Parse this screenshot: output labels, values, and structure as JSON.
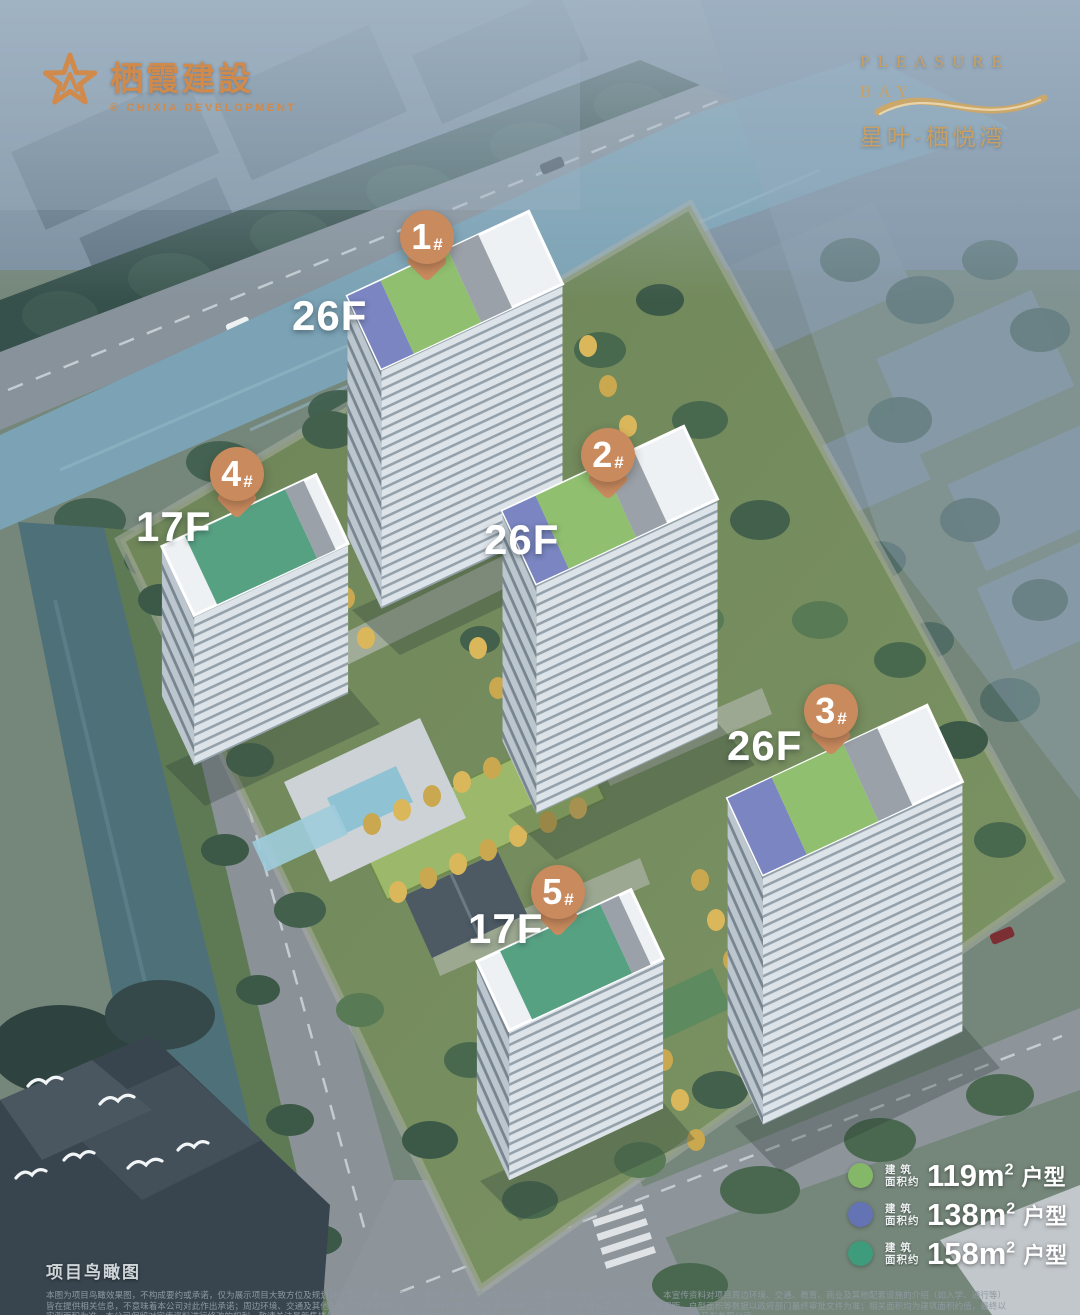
{
  "branding": {
    "developer": {
      "name_zh": "栖霞建設",
      "mark": "®",
      "name_en": "CHIXIA DEVELOPMENT",
      "color": "#cf8a4c"
    },
    "project": {
      "en_line1": "PLEASURE",
      "en_line2": "BAY",
      "name_zh": "星叶·栖悦湾",
      "color": "#c8a065"
    }
  },
  "markers": {
    "pin_color": "#c98a5e",
    "buildings": [
      {
        "number": "1",
        "hash": "#",
        "floors": "26F"
      },
      {
        "number": "2",
        "hash": "#",
        "floors": "26F"
      },
      {
        "number": "3",
        "hash": "#",
        "floors": "26F"
      },
      {
        "number": "4",
        "hash": "#",
        "floors": "17F"
      },
      {
        "number": "5",
        "hash": "#",
        "floors": "17F"
      }
    ]
  },
  "legend": {
    "items": [
      {
        "color": "#85b768",
        "label_top": "建  筑",
        "label_bottom": "面积约",
        "area": "119m",
        "sup": "2",
        "type": "户型"
      },
      {
        "color": "#6473b4",
        "label_top": "建  筑",
        "label_bottom": "面积约",
        "area": "138m",
        "sup": "2",
        "type": "户型"
      },
      {
        "color": "#3e9c7c",
        "label_top": "建  筑",
        "label_bottom": "面积约",
        "area": "158m",
        "sup": "2",
        "type": "户型"
      }
    ]
  },
  "footer": {
    "title": "项目鸟瞰图",
    "disclaimer": "本图为项目鸟瞰效果图，不构成要约或承诺，仅为展示项目大致方位及规划设计意向，最终以政府主管部门批准的规划文件及双方签署的商品房买卖合同约定为准。本宣传资料对项目周边环境、交通、教育、商业及其他配套设施的介绍（如入学、通行等）皆在提供相关信息，不意味着本公司对此作出承诺；周边环境、交通及其他配套设施等信息可能因政府规划调整、市政建设等原因发生变化，敬请留意。绿化率、楼间距、户型面积等数据以政府部门最终审批文件为准；相关面积均为建筑面积约值，最终以实测面积为准。本公司保留对宣传资料进行修改的权利，敬请关注最新售楼处公示资料；部分图片及素材来源于公开渠道，如有侵权请联系删除。开发商：南京栖霞建设房地产开发有限公司。"
  }
}
